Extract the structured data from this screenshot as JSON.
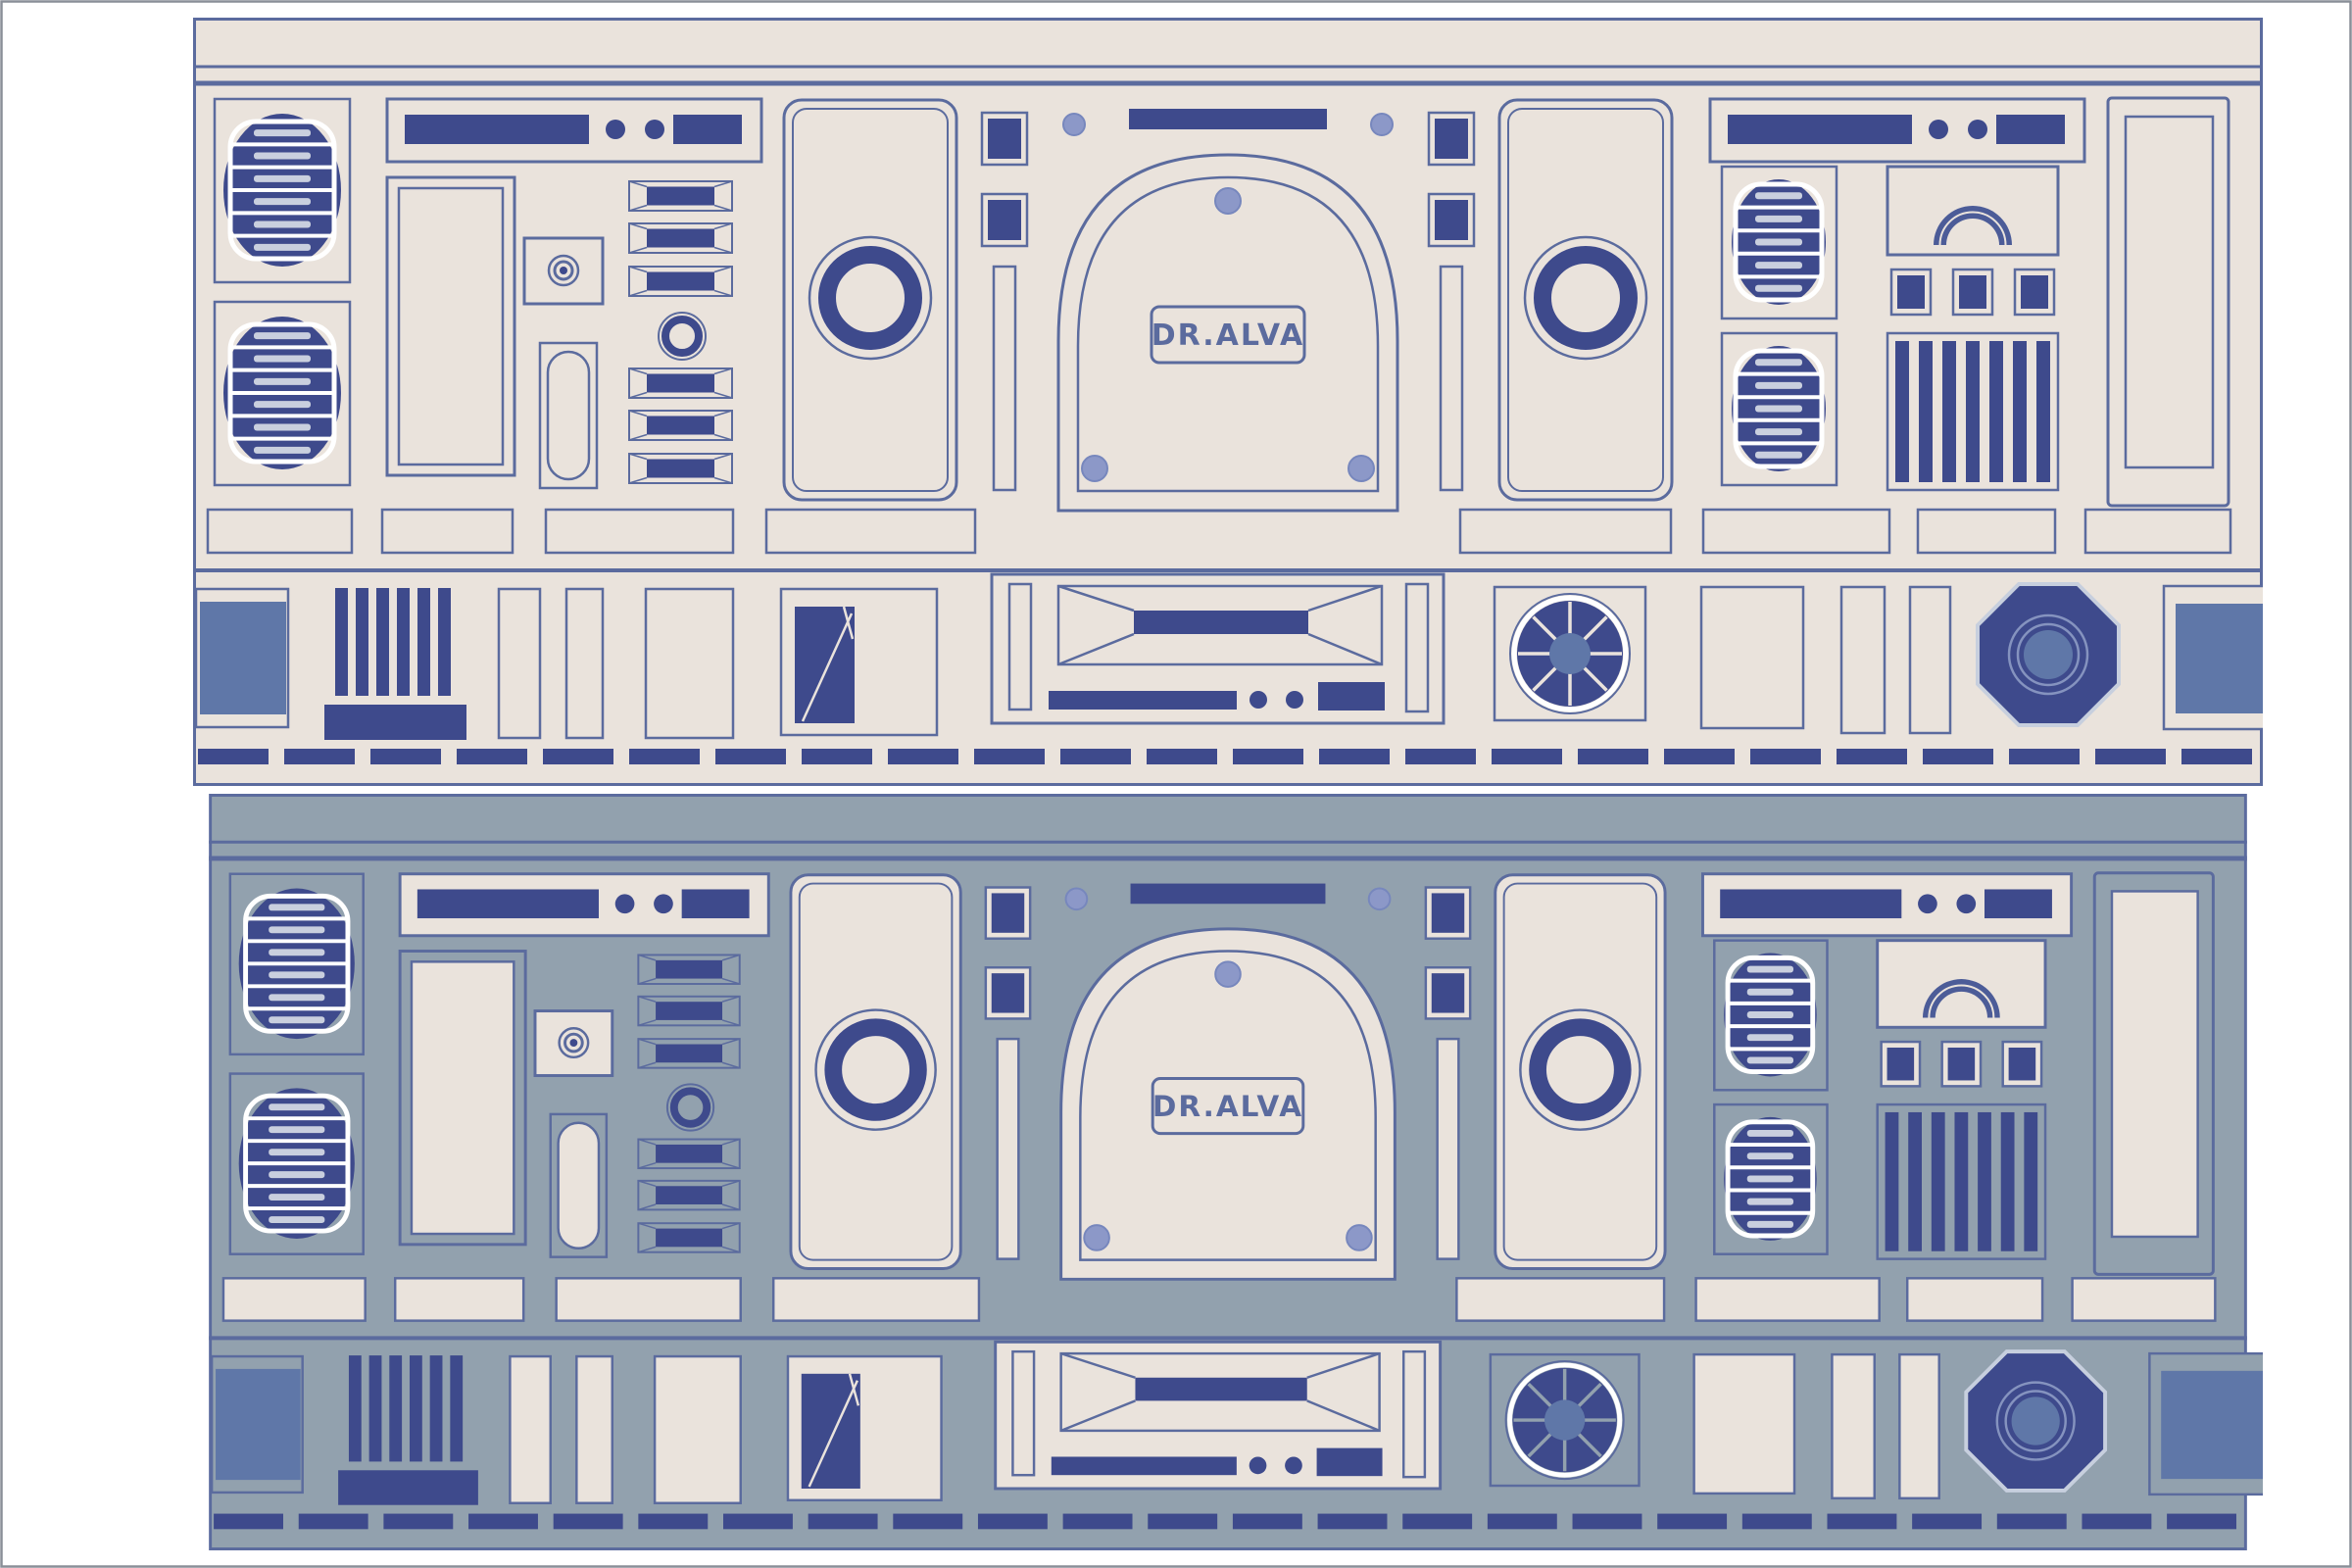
{
  "artwork": {
    "type": "droid-control-panel-illustration",
    "brand_label": "DR.ALVA"
  },
  "palette": {
    "page_bg": "#FFFFFF",
    "frame_border": "#8A8F98",
    "cream": "#EAE3DC",
    "gray_blue": "#92A1AE",
    "navy": "#3E4A8C",
    "slate": "#5B6B9E",
    "arc_fill": "#4C5C98",
    "medium_blue": "#5F77A8",
    "periwinkle": "#8C98C8",
    "periwinkle_stroke": "#7787BD",
    "white": "#FFFFFF",
    "stripe_highlight": "#C9CFDE",
    "octagon_edge": "#C7CFDE",
    "octagon_ring": "#8593BF"
  },
  "panels": [
    {
      "name": "top-panel",
      "background_key": "cream"
    },
    {
      "name": "bottom-panel",
      "background_key": "gray_blue"
    }
  ]
}
